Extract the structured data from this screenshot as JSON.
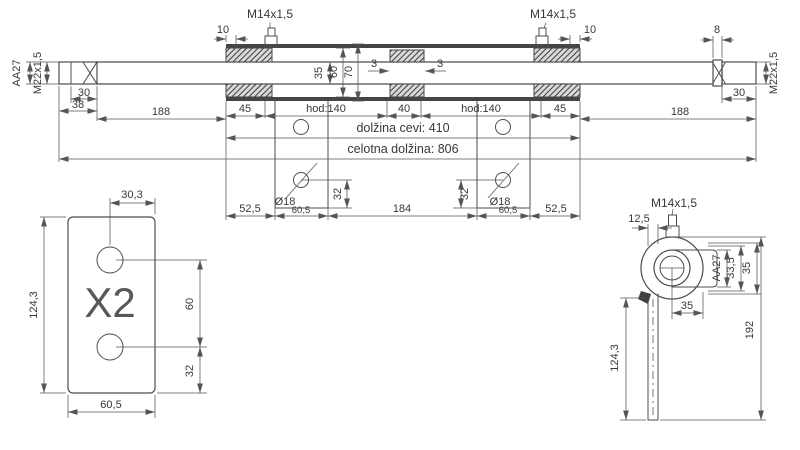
{
  "main": {
    "aa27": "AA27",
    "m22_left": "M22x1,5",
    "len30_left": "30",
    "len38": "38",
    "len188_left": "188",
    "len10_left": "10",
    "m14_left": "M14x1,5",
    "dia35": "35",
    "dia60": "60",
    "dia70": "70",
    "gap3_left": "3",
    "gap3_right": "3",
    "m14_right": "M14x1,5",
    "len10_right": "10",
    "len8": "8",
    "m22_right": "M22x1,5",
    "len30_right": "30",
    "len188_right": "188",
    "len45_left": "45",
    "stroke_left": "hod:140",
    "len40": "40",
    "stroke_right": "hod:140",
    "len45_right": "45",
    "tube_len": "dolžina cevi: 410",
    "total_len": "celotna dolžina: 806",
    "len52_left": "52,5",
    "hole_left": "Ø18",
    "len60_left": "60,5",
    "h32_left": "32",
    "len184": "184",
    "h32_right": "32",
    "hole_right": "Ø18",
    "len60_right": "60,5",
    "len52_right": "52,5"
  },
  "plate": {
    "w30": "30,3",
    "h124": "124,3",
    "qty": "X2",
    "s60": "60",
    "s32": "32",
    "w60": "60,5"
  },
  "side": {
    "m14": "M14x1,5",
    "t12": "12,5",
    "aa27": "AA27",
    "w33": "33,5",
    "w35": "35",
    "off35": "35",
    "h124": "124,3",
    "h192": "192"
  },
  "colors": {
    "line": "#4d4d4d",
    "text": "#383838",
    "background": "#ffffff"
  }
}
